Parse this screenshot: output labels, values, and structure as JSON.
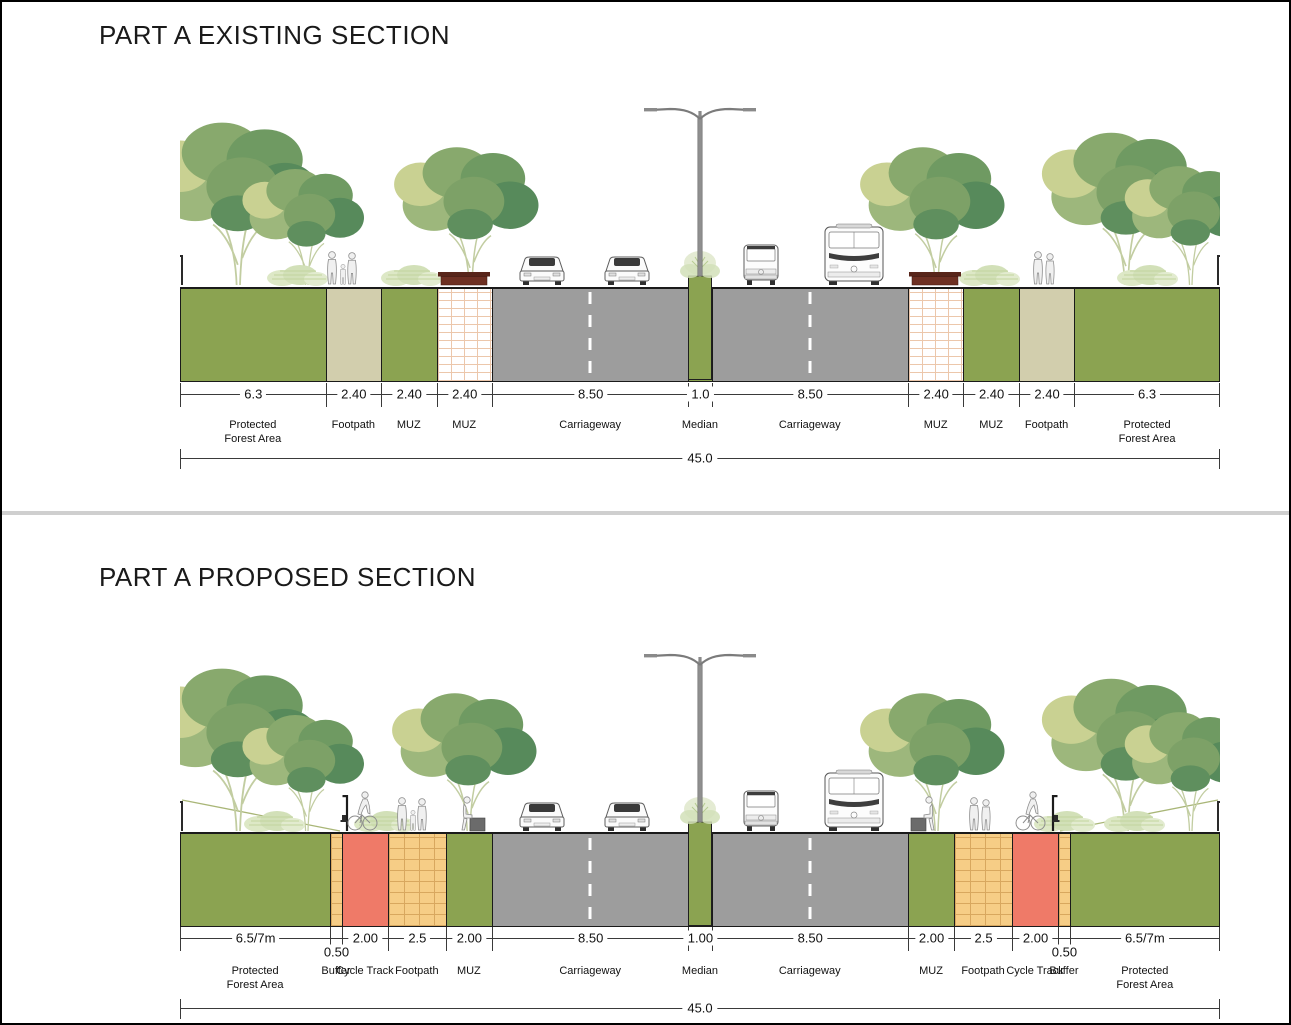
{
  "existing": {
    "title": "PART A EXISTING SECTION",
    "total_dim": "45.0",
    "segments": [
      {
        "dim": "6.3",
        "label": "Protected Forest Area",
        "type": "forest"
      },
      {
        "dim": "2.40",
        "label": "Footpath",
        "type": "footpath"
      },
      {
        "dim": "2.40",
        "label": "MUZ",
        "type": "muz-green"
      },
      {
        "dim": "2.40",
        "label": "MUZ",
        "type": "muz-paved"
      },
      {
        "dim": "8.50",
        "label": "Carriageway",
        "type": "carriageway"
      },
      {
        "dim": "1.0",
        "label": "Median",
        "type": "median"
      },
      {
        "dim": "8.50",
        "label": "Carriageway",
        "type": "carriageway"
      },
      {
        "dim": "2.40",
        "label": "MUZ",
        "type": "muz-paved"
      },
      {
        "dim": "2.40",
        "label": "MUZ",
        "type": "muz-green"
      },
      {
        "dim": "2.40",
        "label": "Footpath",
        "type": "footpath"
      },
      {
        "dim": "6.3",
        "label": "Protected Forest Area",
        "type": "forest"
      }
    ]
  },
  "proposed": {
    "title": "PART A PROPOSED SECTION",
    "total_dim": "45.0",
    "segments": [
      {
        "dim": "6.5/7m",
        "label": "Protected Forest Area",
        "type": "forest"
      },
      {
        "dim": "0.50",
        "label": "Buffer",
        "type": "buffer"
      },
      {
        "dim": "2.00",
        "label": "Cycle Track",
        "type": "cycle-track"
      },
      {
        "dim": "2.5",
        "label": "Footpath",
        "type": "footpath"
      },
      {
        "dim": "2.00",
        "label": "MUZ",
        "type": "muz-green"
      },
      {
        "dim": "8.50",
        "label": "Carriageway",
        "type": "carriageway"
      },
      {
        "dim": "1.00",
        "label": "Median",
        "type": "median"
      },
      {
        "dim": "8.50",
        "label": "Carriageway",
        "type": "carriageway"
      },
      {
        "dim": "2.00",
        "label": "MUZ",
        "type": "muz-green"
      },
      {
        "dim": "2.5",
        "label": "Footpath",
        "type": "footpath"
      },
      {
        "dim": "2.00",
        "label": "Cycle Track",
        "type": "cycle-track"
      },
      {
        "dim": "0.50",
        "label": "Buffer",
        "type": "buffer"
      },
      {
        "dim": "6.5/7m",
        "label": "Protected Forest Area",
        "type": "forest"
      }
    ]
  },
  "colors": {
    "band_green": "#8ba351",
    "band_beige": "#d2cead",
    "carriageway_gray": "#9d9d9d",
    "cycle_track_red": "#ef7a68",
    "footpath_brick_tan": "#f6cd86",
    "paved_brick_white": "#ffffff",
    "planter_brown": "#6e3023",
    "divider_gray": "#cfcfcf"
  }
}
